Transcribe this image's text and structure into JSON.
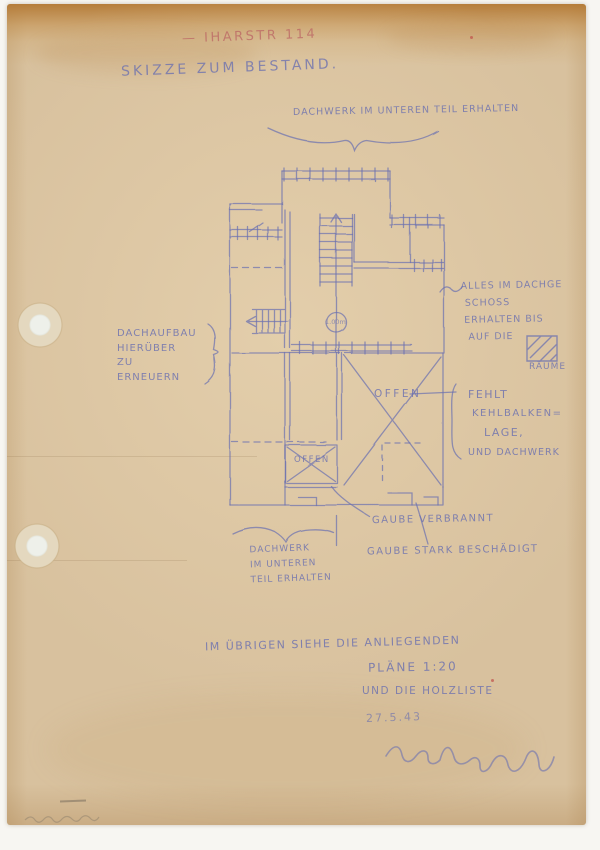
{
  "colors": {
    "paper": "#d8c19e",
    "paper_top_band": "#b27630",
    "ink_blue": "#6c71b0",
    "ink_red": "#bd6a66",
    "background": "#f7f6f2"
  },
  "header": {
    "street": "— IHARSTR 114",
    "title": "SKIZZE ZUM BESTAND."
  },
  "plan": {
    "top_note": "DACHWERK IM UNTEREN TEIL ERHALTEN",
    "left_note": [
      "DACHAUFBAU",
      "HIERÜBER",
      "ZU",
      "ERNEUERN"
    ],
    "right_note": [
      "ALLES IM DACHGE",
      "SCHOSS",
      "ERHALTEN BIS",
      "AUF DIE"
    ],
    "raeume": "RÄUME",
    "fehlt": [
      "FEHLT",
      "KEHLBALKEN=",
      "LAGE,"
    ],
    "und_dachwerk": "UND DACHWERK",
    "offen_large": "OFFEN",
    "offen_small": "OFFEN",
    "stair_circle": "1.00m",
    "gaube1": "GAUBE VERBRANNT",
    "gaube2": "GAUBE STARK BESCHÄDIGT",
    "bottom_note": [
      "DACHWERK",
      "IM UNTEREN",
      "TEIL ERHALTEN"
    ]
  },
  "footer": {
    "line1": "IM ÜBRIGEN SIEHE DIE ANLIEGENDEN",
    "line2": "PLÄNE 1:20",
    "line3": "UND DIE HOLZLISTE",
    "date": "27.5.43"
  }
}
